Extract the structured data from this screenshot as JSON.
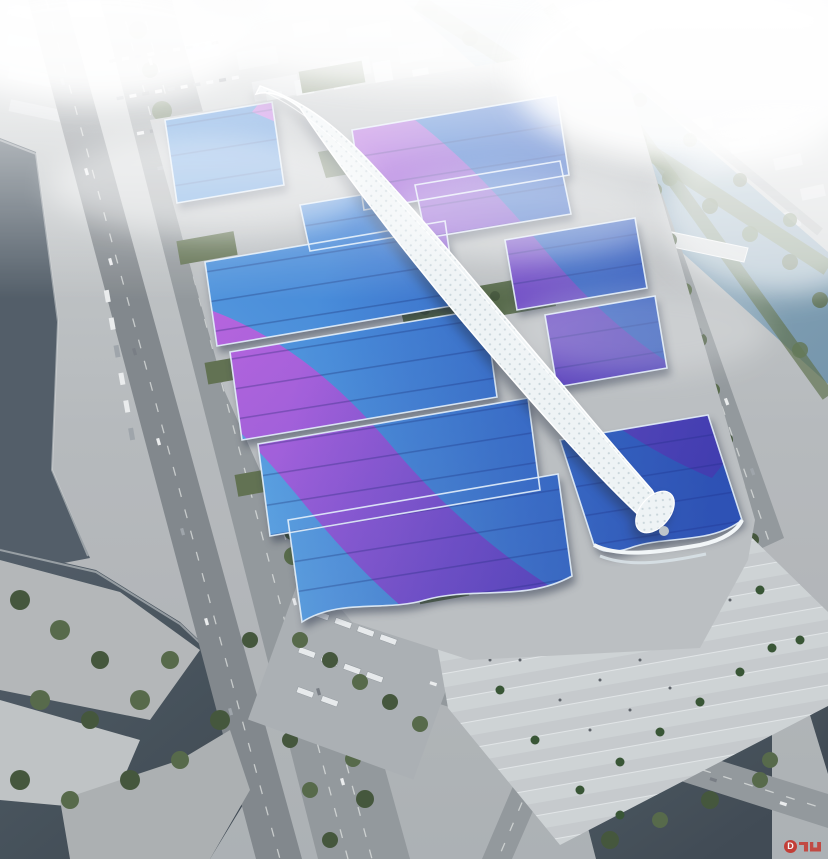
{
  "title": "Aerial rendering of a riverside exhibition and convention center complex",
  "watermark": {
    "label": "D"
  },
  "palette": {
    "ground": "#b3b7ba",
    "ground-light": "#c8cccd",
    "apron": "#b8bcbf",
    "road": "#8e9498",
    "road-dark": "#7c8287",
    "lane": "#e4e7e6",
    "water-dark": "#37424c",
    "water-mid": "#4a5661",
    "river-light": "#9db8c9",
    "river-deep": "#6f91a8",
    "roof-light": "#66b0e6",
    "roof-mid": "#3f86d8",
    "roof-deep": "#2254c4",
    "roof-indigo": "#15289a",
    "purple": "#9b4ad4",
    "magenta": "#d457e0",
    "violet": "#6c38c0",
    "spine": "#eef3f5",
    "spine-dot": "#c7d4da",
    "green-dark": "#3c4f33",
    "green-mid": "#4f6342",
    "green-light": "#5d7350",
    "green-roof": "#5a6b4a",
    "plaza-a": "#ccd1d3",
    "plaza-b": "#c3c8cb",
    "city": "#d9dde0",
    "tower": "#e6eaec",
    "fog": "#ffffff",
    "red": "#c53229",
    "crowd": "#c03028"
  },
  "scene": {
    "regions": [
      "foggy-city-skyline",
      "northeast-river",
      "west-canal",
      "southwest-lake",
      "southeast-pond",
      "west-boulevard",
      "west-expressway",
      "east-riverside-road",
      "south-road",
      "road-intersection",
      "exhibition-halls",
      "purple-roof-ribbons",
      "central-spine-corridor",
      "entrance-hall",
      "south-plaza",
      "visitor-crowd",
      "palm-trees",
      "parking-lots",
      "bus-depot",
      "waterfront-park"
    ]
  }
}
